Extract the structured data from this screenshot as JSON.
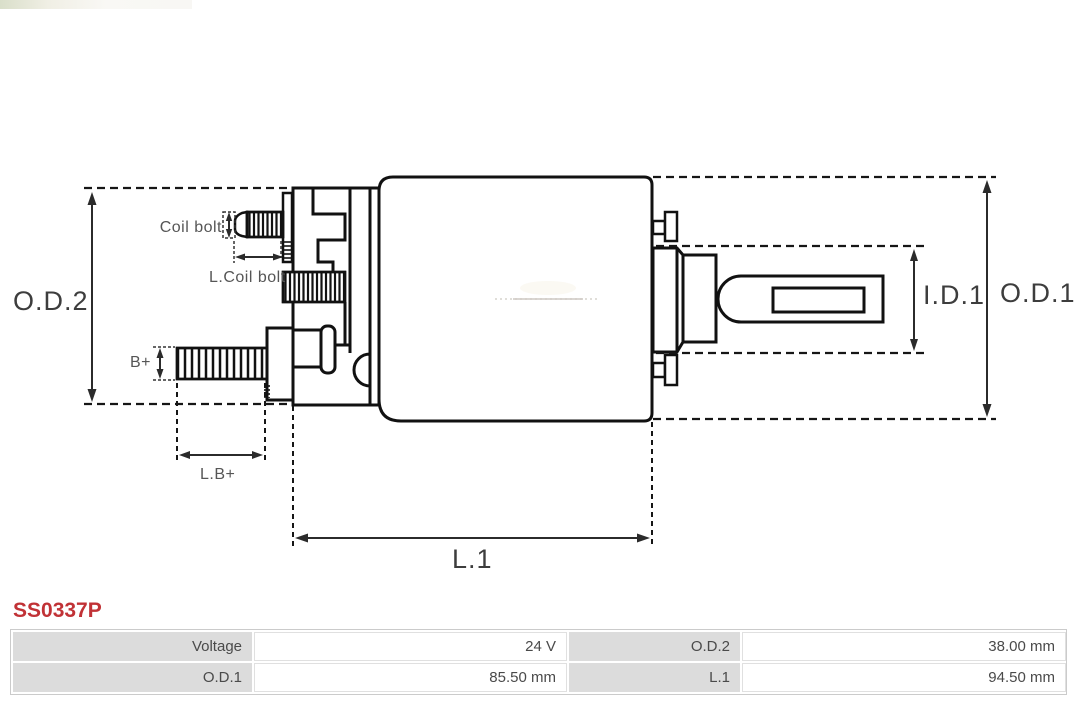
{
  "part_number": "SS0337P",
  "diagram": {
    "labels": {
      "od2": "O.D.2",
      "od1": "O.D.1",
      "id1": "I.D.1",
      "l1": "L.1",
      "coil_bolt": "Coil bolt",
      "l_coil_bolt": "L.Coil bolt",
      "b_plus": "B+",
      "l_b_plus": "L.B+"
    }
  },
  "specs_table": {
    "rows": [
      [
        {
          "label": "Voltage",
          "value": "24 V"
        },
        {
          "label": "O.D.2",
          "value": "38.00 mm"
        }
      ],
      [
        {
          "label": "O.D.1",
          "value": "85.50 mm"
        },
        {
          "label": "L.1",
          "value": "94.50 mm"
        }
      ]
    ]
  },
  "colors": {
    "part_number_red": "#c13236",
    "table_label_bg": "#dcdcdc",
    "diagram_line": "#111111",
    "dimension_text": "#3d3d3d"
  }
}
